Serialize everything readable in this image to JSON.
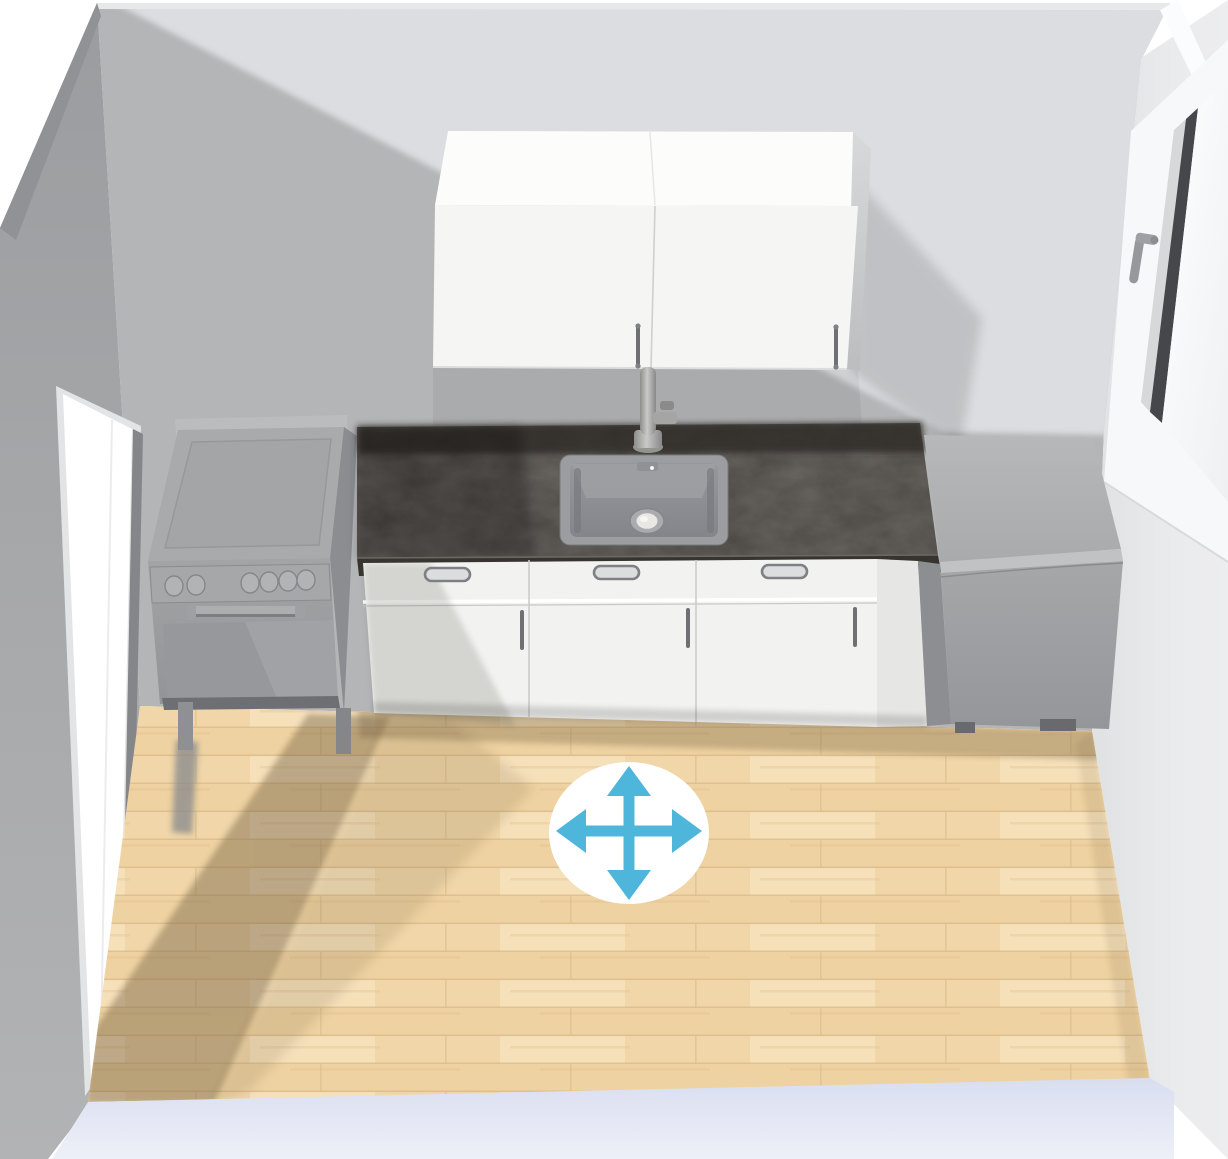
{
  "app": {
    "name": "3D Kitchen Planner",
    "view_label": "kitchen-3d-preview"
  },
  "canvas": {
    "width": 1228,
    "height": 1159,
    "background": "#ffffff"
  },
  "colors": {
    "accent_blue": "#4eb6db",
    "cursor_circle": "#ffffff",
    "wall_back_shadow": "#b4b5b7",
    "wall_back_lit": "#dcdde0",
    "wall_top_edge": "#e7e8e9",
    "wall_left_top": "#9da0a3",
    "wall_left_bottom": "#b0b1b3",
    "wall_right": "#e9eaec",
    "floor_wood": "#f2d9ad",
    "floor_plank_gap": "#dcba8a",
    "floor_shadow": "#6f5d41",
    "baseboard_slab": "#dfe3f1",
    "countertop": "#4b4743",
    "countertop_back_band": "#2e2b28",
    "cabinet_white": "#f2f2f0",
    "cabinet_top_white": "#fcfcfb",
    "appliance_gray": "#a2a3a5",
    "sink_gray": "#9b9da0",
    "handle_gray": "#6f7073",
    "window_glass_edge": "#45474a",
    "door_white": "#ffffff"
  },
  "cursor": {
    "type": "move-pan-four-way-arrow",
    "color": "#4eb6db",
    "circle_color": "#ffffff",
    "position_x": 629,
    "position_y": 833
  },
  "scene": {
    "room": {
      "walls": [
        "back",
        "left",
        "right"
      ],
      "floor": "light-wood-planks",
      "door": {
        "wall": "left",
        "appearance": "open-white-doorway"
      },
      "window": {
        "wall": "right",
        "frame": "white",
        "handle": "gray-lever"
      }
    },
    "objects": [
      {
        "id": "wall-cabinet",
        "type": "two-door wall cabinet",
        "finish": "white",
        "handles": 2
      },
      {
        "id": "range-cooker",
        "type": "freestanding range",
        "finish": "gray",
        "knobs": 6,
        "oven_handle": true,
        "legs": 2
      },
      {
        "id": "countertop",
        "type": "worktop",
        "finish": "dark-concrete"
      },
      {
        "id": "sink",
        "type": "inset single-bowl sink",
        "drain": true,
        "overflow": true
      },
      {
        "id": "faucet",
        "type": "tall mixer tap",
        "finish": "stainless"
      },
      {
        "id": "base-cabinet-run",
        "type": "base cabinets",
        "units": 3,
        "drawers": 3,
        "doors": 3,
        "finish": "white"
      },
      {
        "id": "refrigerator",
        "type": "under-worktop appliance",
        "finish": "gray",
        "feet": 2
      }
    ]
  }
}
